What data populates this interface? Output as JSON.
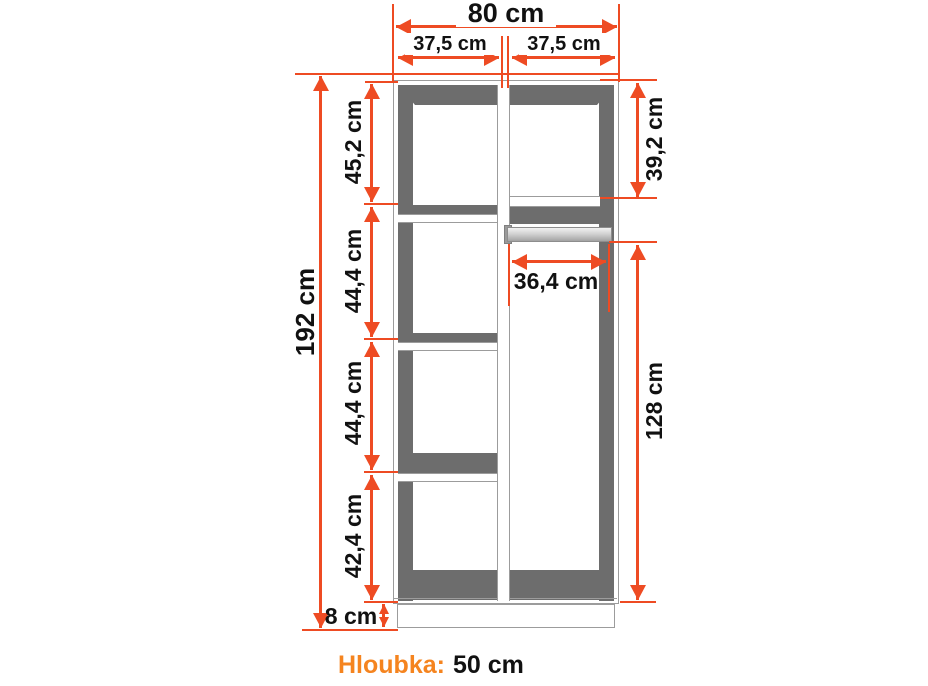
{
  "dimensions": {
    "total_width": "80 cm",
    "left_column_width": "37,5 cm",
    "right_column_width": "37,5 cm",
    "total_height": "192 cm",
    "left_sections": [
      "45,2 cm",
      "44,4 cm",
      "44,4 cm",
      "42,4 cm"
    ],
    "right_top_section": "39,2 cm",
    "rod_width": "36,4 cm",
    "right_lower_section": "128 cm",
    "plinth_height": "8 cm"
  },
  "depth": {
    "label": "Hloubka:",
    "value": "50 cm"
  },
  "colors": {
    "dimension_orange": "#ee4b23",
    "depth_label_orange": "#f5841f",
    "cabinet_shadow_gray": "#6d6d6d",
    "outline_gray": "#9c9c9c",
    "text_black": "#111111"
  }
}
